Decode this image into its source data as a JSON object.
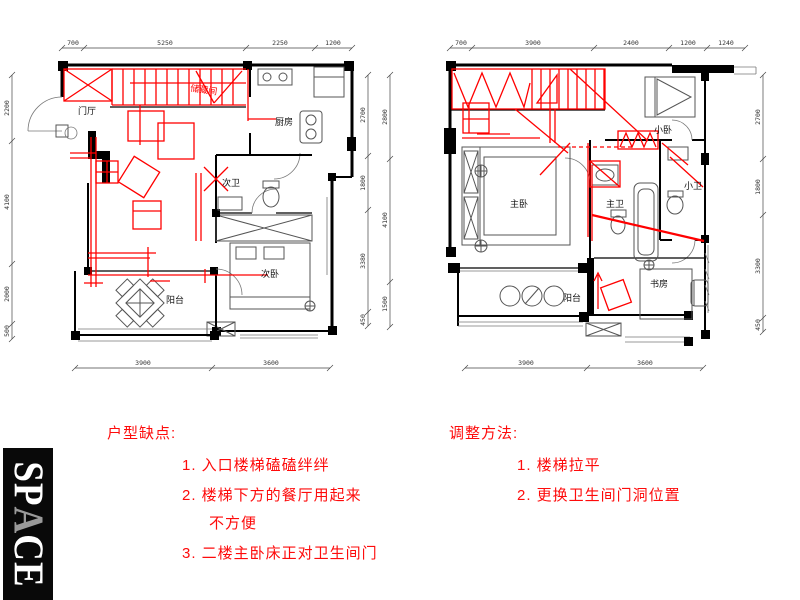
{
  "logo": {
    "letters": [
      "S",
      "P",
      "A",
      "C",
      "E"
    ]
  },
  "left_plan": {
    "rooms": {
      "entry": "门厅",
      "storage": "储藏间",
      "kitchen": "厨房",
      "bath": "次卫",
      "bedroom": "次卧",
      "balcony": "阳台"
    },
    "dims": {
      "top": [
        "700",
        "5250",
        "2250",
        "1200"
      ],
      "left": [
        "2200",
        "4100",
        "2000",
        "500"
      ],
      "right_inner": [
        "2700",
        "1800",
        "3380",
        "450"
      ],
      "right_outer": [
        "2800",
        "4100",
        "1500"
      ],
      "bottom": [
        "3900",
        "3600"
      ]
    }
  },
  "right_plan": {
    "rooms": {
      "small_bedroom": "小卧",
      "master_bedroom": "主卧",
      "master_bath": "主卫",
      "small_bath": "小卫",
      "study": "书房",
      "balcony": "阳台"
    },
    "dims": {
      "top": [
        "700",
        "3900",
        "2400",
        "1200",
        "1240"
      ],
      "right": [
        "2700",
        "1800",
        "3300",
        "450"
      ],
      "bottom": [
        "3900",
        "3600"
      ]
    }
  },
  "notes": {
    "defects": {
      "title": "户型缺点:",
      "items": [
        "1. 入口楼梯磕磕绊绊",
        "2. 楼梯下方的餐厅用起来",
        "不方便",
        "3. 二楼主卧床正对卫生间门"
      ]
    },
    "adjustments": {
      "title": "调整方法:",
      "items": [
        "1. 楼梯拉平",
        "2. 更换卫生间门洞位置"
      ]
    }
  },
  "colors": {
    "annotation": "#ff0000",
    "wall": "#000000",
    "dim_text": "#333333"
  }
}
